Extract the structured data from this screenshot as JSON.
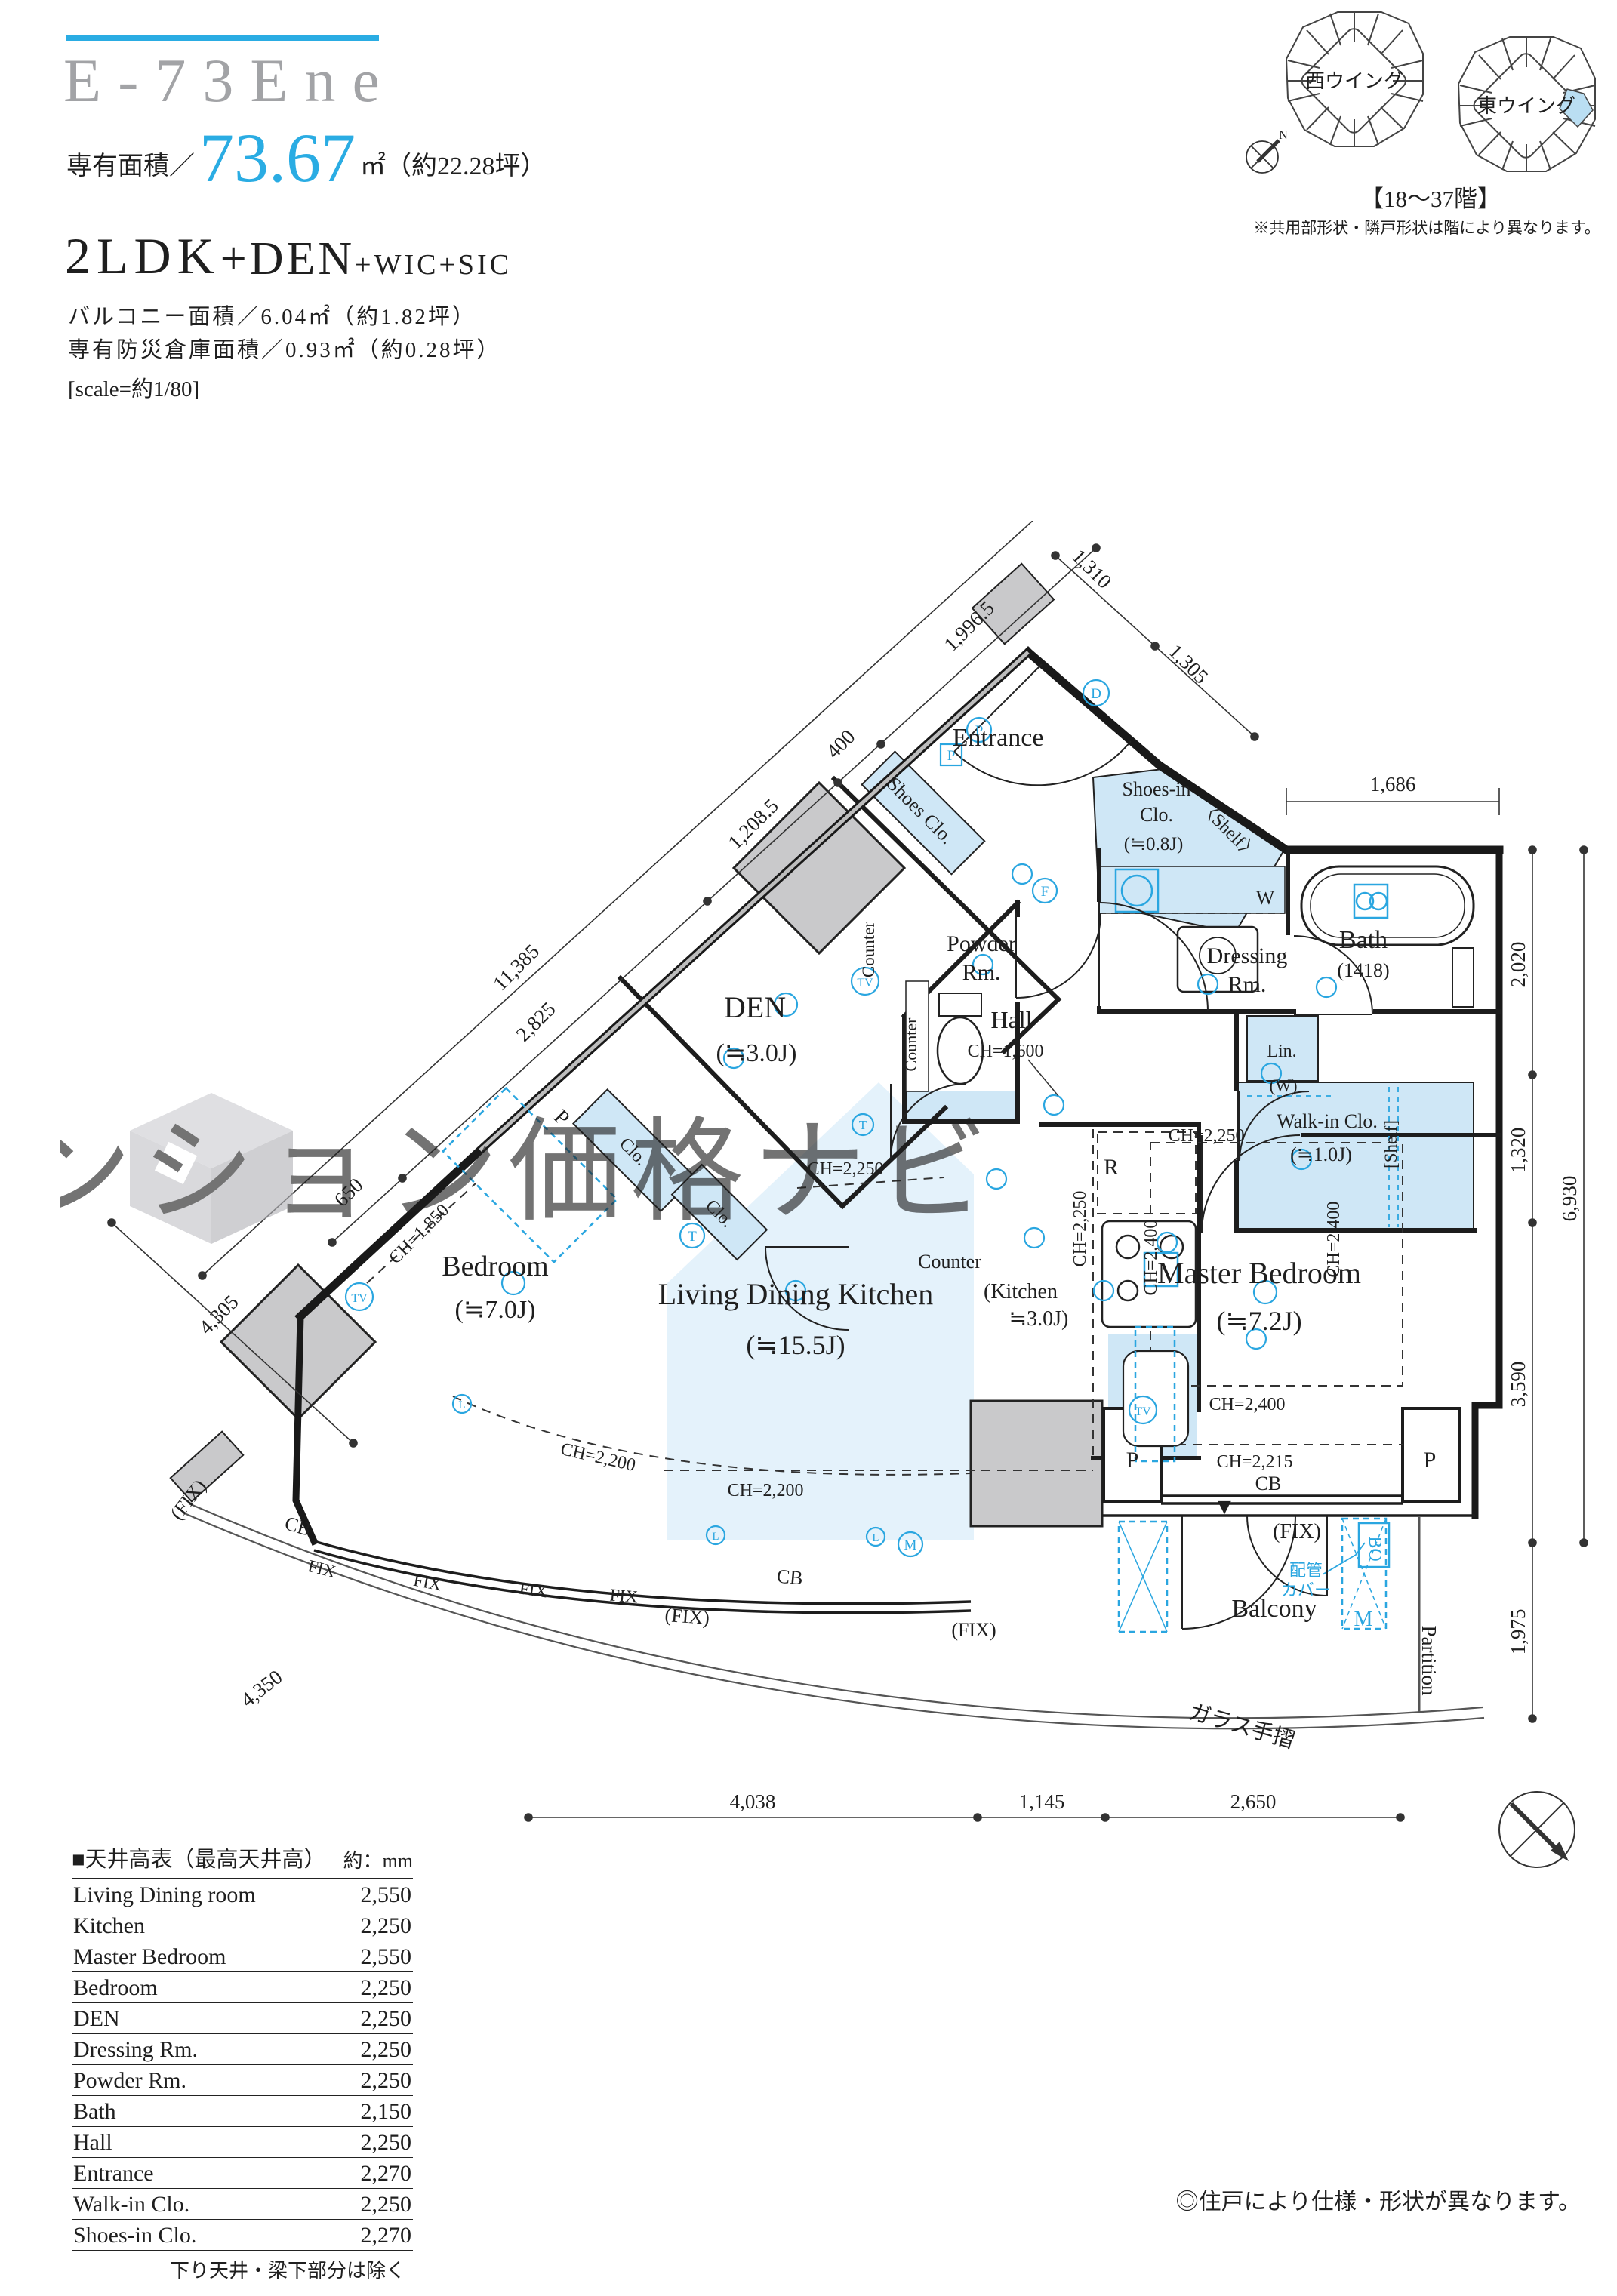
{
  "header": {
    "unit_no": "E-73Ene",
    "area_label": "専有面積／",
    "area_value": "73.67",
    "area_unit": "㎡（約22.28坪）",
    "layout_main": "2LDK",
    "layout_plus1": "+DEN",
    "layout_plus2": "+WIC+SIC",
    "balcony_line": "バルコニー面積／6.04㎡（約1.82坪）",
    "storage_line": "専有防災倉庫面積／0.93㎡（約0.28坪）",
    "scale_line": "[scale=約1/80]"
  },
  "wings": {
    "west": "西ウイング",
    "east": "東ウイング",
    "floors": "【18〜37階】",
    "note": "※共用部形状・隣戸形状は階により異なります。",
    "north": "N"
  },
  "watermark": "湾岸マンション価格ナビ",
  "plan": {
    "rooms": {
      "entrance": "Entrance",
      "shoes_clo": "Shoes Clo.",
      "shoes_in_1": "Shoes-in",
      "shoes_in_2": "Clo.",
      "shoes_in_size": "(≒0.8J)",
      "shelf_angle": "〈Shelf〉",
      "powder_1": "Powder",
      "powder_2": "Rm.",
      "counter": "Counter",
      "hall": "Hall",
      "dressing_1": "Dressing",
      "dressing_2": "Rm.",
      "w": "W",
      "bath": "Bath",
      "bath_size": "(1418)",
      "lin": "Lin.",
      "w_paren": "(W)",
      "wic": "Walk-in Clo.",
      "wic_size": "(≒1.0J)",
      "shelf_sq": "[Shelf]",
      "den": "DEN",
      "den_size": "(≒3.0J)",
      "clo_a": "Clo.",
      "clo_b": "Clo.",
      "bedroom": "Bedroom",
      "bedroom_size": "(≒7.0J)",
      "ldk": "Living Dining Kitchen",
      "ldk_size": "(≒15.5J)",
      "kitchen_1": "(Kitchen",
      "kitchen_2": "≒3.0J)",
      "r": "R",
      "master": "Master Bedroom",
      "master_size": "(≒7.2J)",
      "balcony": "Balcony"
    },
    "ch": {
      "hall": "CH=1,600",
      "den": "CH=2,250",
      "kitchen": "CH=2,250",
      "master_top": "CH=2,250",
      "master_left": "CH=2,400",
      "master_right": "CH=2,400",
      "master_bottom": "CH=2,400",
      "master_low": "CH=2,215",
      "ldk": "CH=2,200",
      "bedroom": "CH=2,200",
      "bedroom_win": "CH=1,850"
    },
    "dims": {
      "total_left": "11,385",
      "d650": "650",
      "d2825": "2,825",
      "d12085": "1,208.5",
      "d400": "400",
      "d19965": "1,996.5",
      "d1310": "1,310",
      "d1305": "1,305",
      "d1686": "1,686",
      "d2020": "2,020",
      "d1320": "1,320",
      "d3590": "3,590",
      "d1975": "1,975",
      "total_right": "6,930",
      "d4038": "4,038",
      "d1145": "1,145",
      "d2650": "2,650",
      "d4305": "4,305",
      "d4350": "4,350"
    },
    "marks": {
      "cb": "CB",
      "p": "P",
      "fix": "FIX",
      "fixp": "(FIX)",
      "partition": "Partition",
      "glass_rail": "ガラス手摺",
      "pipe_1": "配管",
      "pipe_2": "カバー",
      "bo": "BO",
      "m": "M",
      "tv": "TV",
      "t": "T",
      "f": "F",
      "d": "D",
      "l": "L",
      "tri": "▼"
    }
  },
  "table": {
    "title": "■天井高表（最高天井高）",
    "unit": "約：mm",
    "rows": [
      [
        "Living Dining room",
        "2,550"
      ],
      [
        "Kitchen",
        "2,250"
      ],
      [
        "Master Bedroom",
        "2,550"
      ],
      [
        "Bedroom",
        "2,250"
      ],
      [
        "DEN",
        "2,250"
      ],
      [
        "Dressing Rm.",
        "2,250"
      ],
      [
        "Powder Rm.",
        "2,250"
      ],
      [
        "Bath",
        "2,150"
      ],
      [
        "Hall",
        "2,250"
      ],
      [
        "Entrance",
        "2,270"
      ],
      [
        "Walk-in Clo.",
        "2,250"
      ],
      [
        "Shoes-in Clo.",
        "2,270"
      ]
    ],
    "footnote": "下り天井・梁下部分は除く"
  },
  "footer_note": "◎住戸により仕様・形状が異なります。"
}
